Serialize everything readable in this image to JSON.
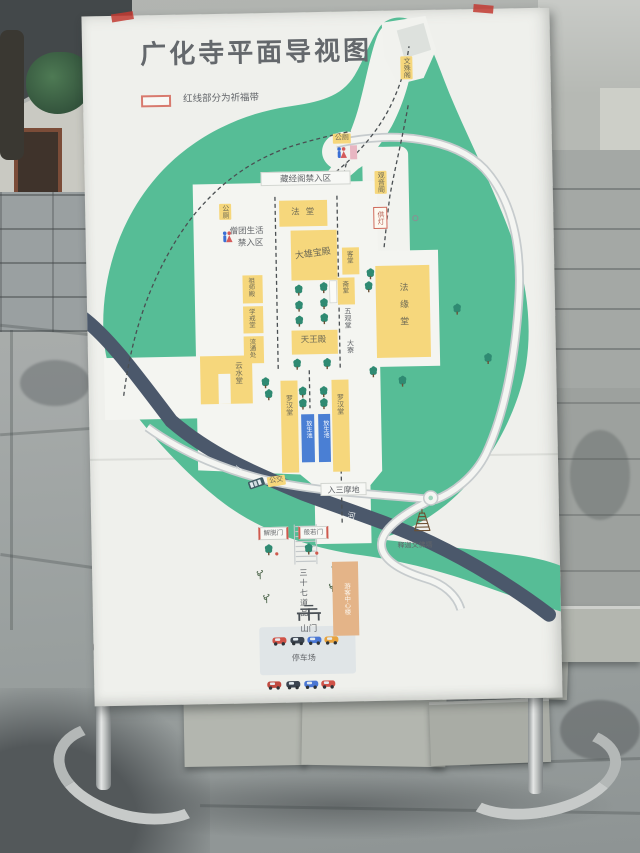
{
  "sign": {
    "title": "广化寺平面导视图",
    "legend_text": "红线部分为祈福带",
    "labels": {
      "wenshu_pavilion": "文殊阁",
      "toilet_top": "公厕",
      "toilet_left": "公厕",
      "sutra_area": "藏经阁禁入区",
      "fa_hall": "法堂",
      "monk_area_line1": "僧团生活",
      "monk_area_line2": "禁入区",
      "main_hall": "大雄宝殿",
      "guanyin_pavilion": "观音阁",
      "lamp_offering": "供灯",
      "guest_hall": "客堂",
      "dining_hall": "斋堂",
      "patriarch_hall": "祖师殿",
      "precepts_hall": "学戒堂",
      "distribution_office": "流通处",
      "five_contemplations_hall": "五观堂",
      "kitchen": "大寮",
      "fayuan_hall": "法缘堂",
      "heavenly_kings_hall": "天王殿",
      "cloud_water_hall": "云水堂",
      "arhat_hall_left": "罗汉堂",
      "arhat_hall_right": "罗汉堂",
      "release_pond_left": "放生池",
      "release_pond_right": "放生池",
      "samadhi_gate": "入三摩地",
      "bus_stop": "公交",
      "river_1": "河",
      "river_2": "河",
      "liberation_gate": "解脱门",
      "prajna_gate": "般若门",
      "thirty_seven_path": "三十七道品",
      "visitor_center": "游客中心楼",
      "mountain_gate": "山门",
      "parking_lot": "停车场",
      "pagoda": "释迦文佛塔"
    },
    "colors": {
      "grounds_green": "#56bd96",
      "building_yellow": "#f6d77c",
      "river_slate": "#4b586b",
      "pond_blue": "#4a7fd4",
      "prayer_red": "#cf5a4e",
      "visitor_tan": "#e4b488"
    }
  }
}
